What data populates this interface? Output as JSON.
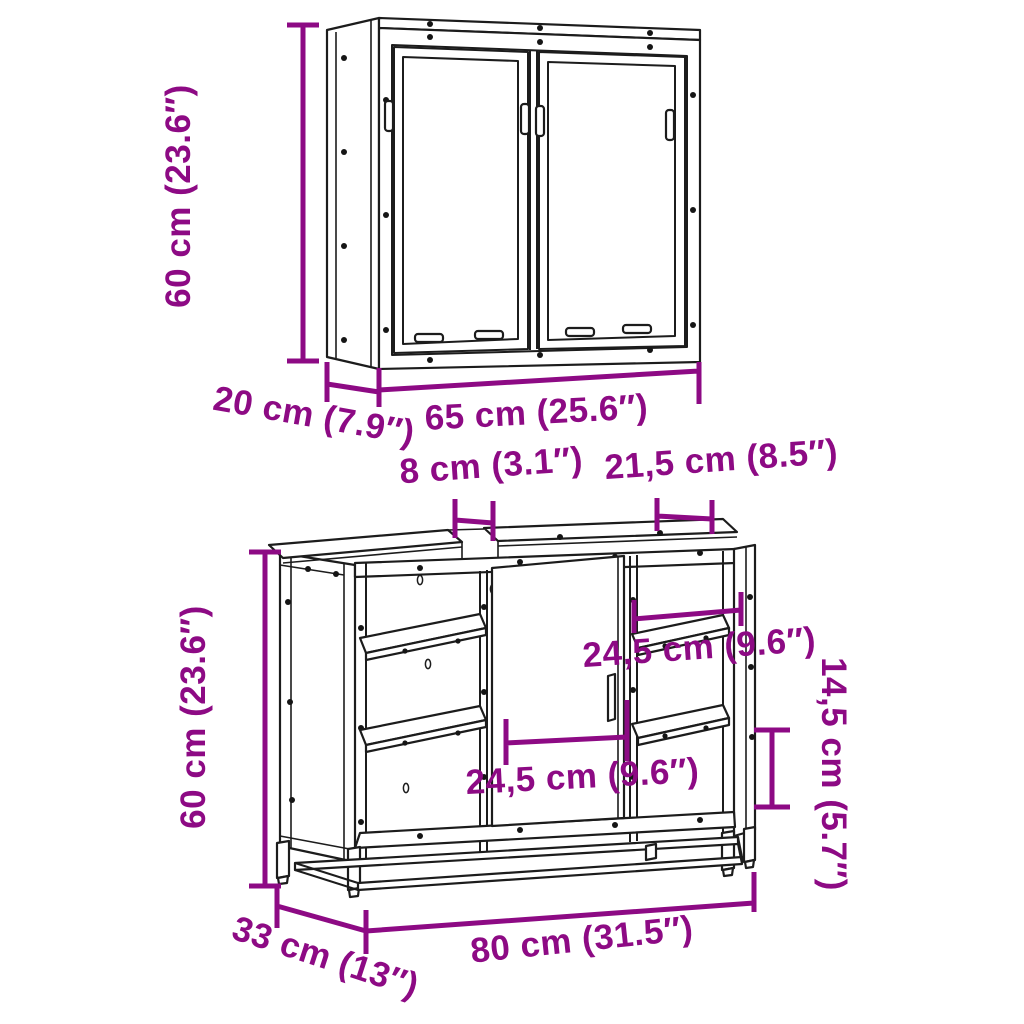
{
  "page": {
    "background": "#ffffff",
    "accent_color": "#8D0A84",
    "line_color": "#1c1c1c"
  },
  "mirror_cabinet": {
    "height_label": "60 cm (23.6″)",
    "depth_label": "20 cm (7.9″)",
    "width_label": "65 cm (25.6″)"
  },
  "vanity_cabinet": {
    "height_label": "60 cm (23.6″)",
    "top_gap_label": "8 cm (3.1″)",
    "top_right_width_label": "21,5 cm (8.5″)",
    "right_shelf_width_label": "24,5 cm (9.6″)",
    "door_width_label": "24,5 cm (9.6″)",
    "right_section_height_label": "14,5 cm (5.7″)",
    "depth_label": "33 cm (13″)",
    "width_label": "80 cm (31.5″)"
  }
}
